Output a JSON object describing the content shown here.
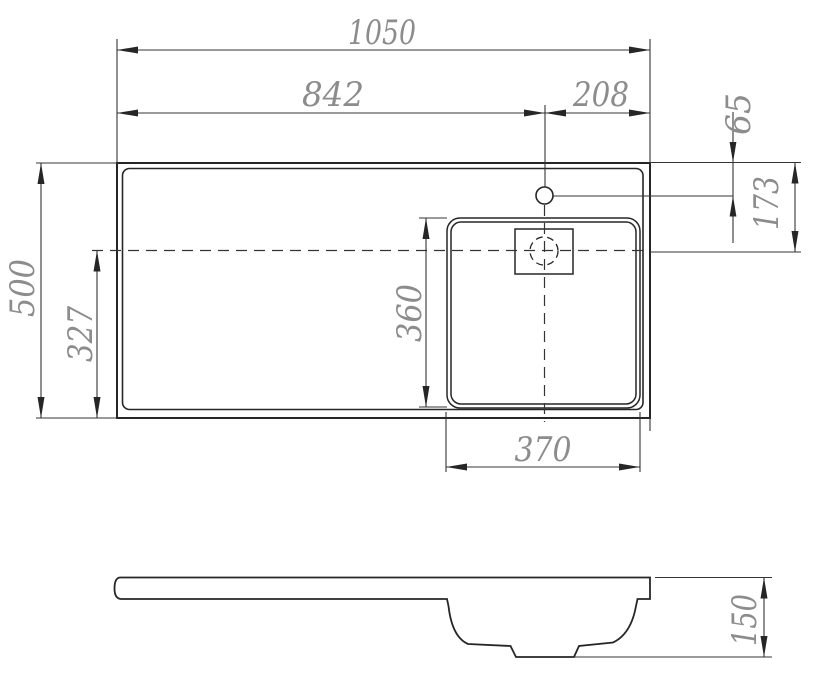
{
  "page": {
    "background": "#ffffff",
    "title": "washbasin-dimension-drawing"
  },
  "drawing": {
    "line_color": "#262626",
    "dim_text_color": "#8c8c8c",
    "top_view": {
      "dims": {
        "overall_width": "1050",
        "left_edge_to_faucet": "842",
        "faucet_to_right_edge": "208",
        "top_edge_to_faucet": "65",
        "top_edge_to_bowl_center": "173",
        "overall_depth": "500",
        "bowl_center_to_bottom_edge": "327",
        "bowl_depth": "360",
        "bowl_width": "370"
      }
    },
    "side_view": {
      "dims": {
        "overall_height": "150"
      }
    }
  }
}
